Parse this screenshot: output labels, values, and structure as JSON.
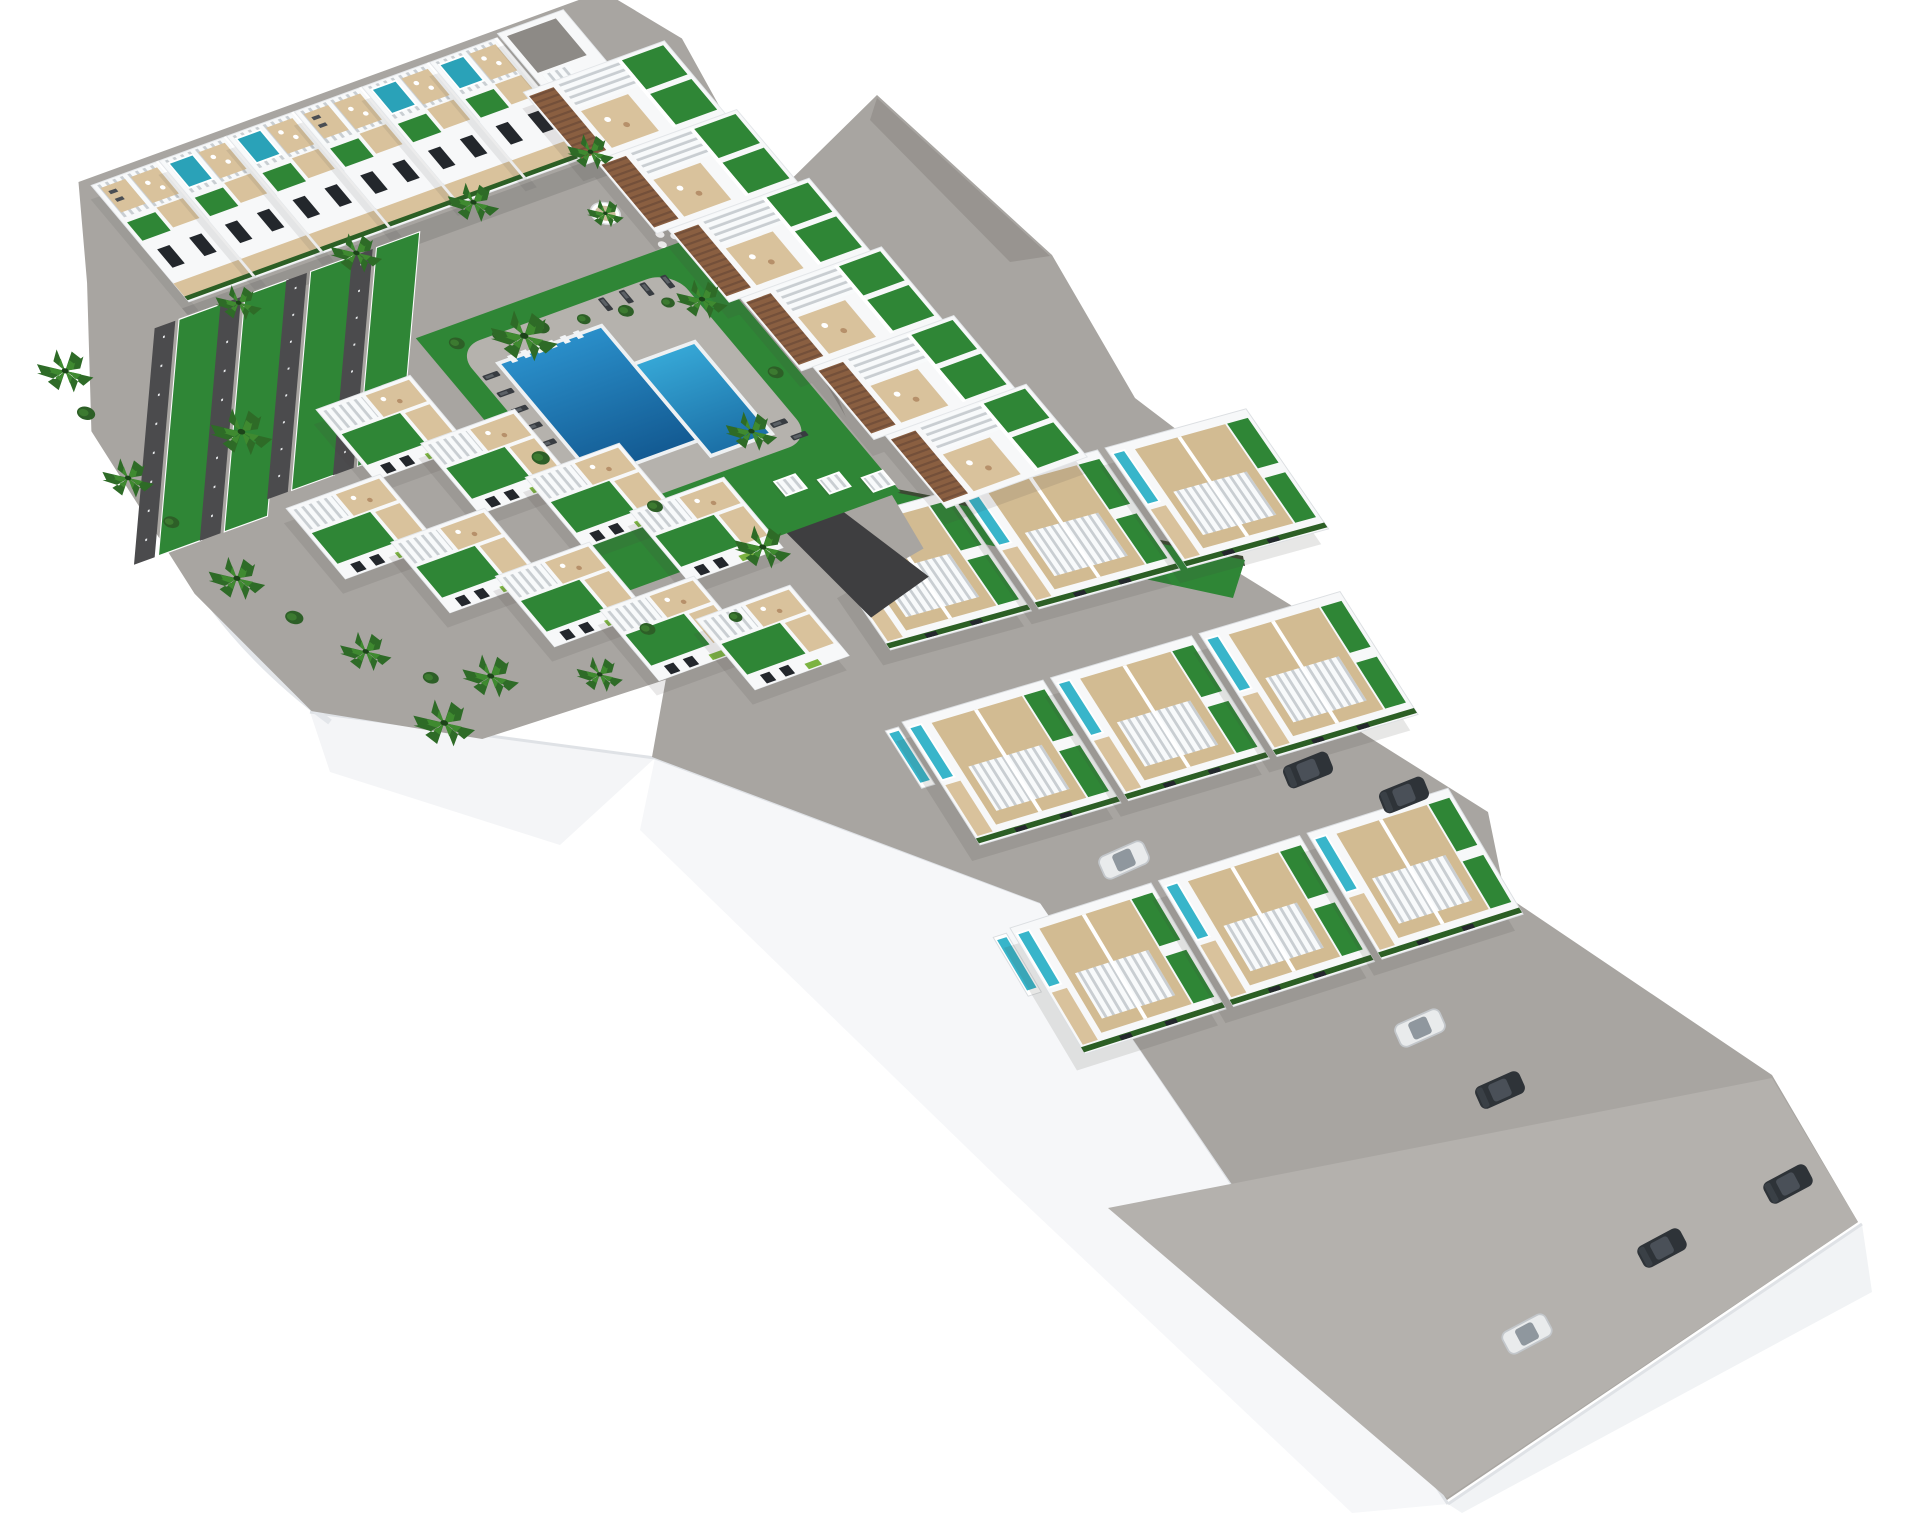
{
  "title": "Aerial 3D architectural render of a white Mediterranean residential complex with communal pool, grass-covered parking rows, rooftop terraces and three rows of detached villas",
  "colors": {
    "bg": "#ffffff",
    "road": "#a8a5a1",
    "roadlight": "#b4b1ad",
    "roaddark": "#8f8c88",
    "pathdark": "#3e3e40",
    "grass": "#2f8636",
    "grassdark": "#27702c",
    "hedge": "#2c5f25",
    "hedgedark": "#3c4a33",
    "gabion": "#6b5138",
    "pooldeep": "#135a92",
    "poolmain": "#2a8fca",
    "poollight": "#36a7d6",
    "poolroof": "#2aa2b8",
    "poolvilla": "#38b5ca",
    "deck": "#d9c29c",
    "deck2": "#d2bb92",
    "pooldeckgray": "#b5b2ad",
    "bwhite": "#f7f8f9",
    "wallshade": "#d9dcde",
    "win": "#23272c",
    "wood": "#8a5f41",
    "slatgap": "#c9ced2",
    "cardark": "#2e3338",
    "carwhite": "#e9ebec",
    "plinth": "#f4f5f7",
    "plinthedge": "#dfe2e6",
    "shadow": "rgba(66,63,58,0.28)"
  },
  "inventory": {
    "main_block": {
      "top_townhouse_units": 6,
      "corner_building": 1,
      "apartment_units": 6,
      "bottom_townhouses": 9,
      "grass_parking_strips": 4,
      "communal_pools": 2,
      "rooftop_pools": 4,
      "sun_loungers": 11,
      "pool_cabanas": 3,
      "palm_trees": 16
    },
    "right_wing": {
      "villa_rows": 3,
      "villa_pairs_per_row": 3,
      "private_plunge_pools": 9,
      "parked_cars": 8
    }
  },
  "instances": {
    "top_row_units": [
      [
        0,
        -6,
        "deck"
      ],
      [
        72,
        -6,
        "pool"
      ],
      [
        144,
        -6,
        "pool"
      ],
      [
        216,
        -6,
        "deck"
      ],
      [
        288,
        -6,
        "pool"
      ],
      [
        360,
        -6,
        "pool"
      ]
    ],
    "apartment_units": [
      [
        416,
        58
      ],
      [
        428,
        153
      ],
      [
        440,
        248
      ],
      [
        452,
        343
      ],
      [
        464,
        438
      ],
      [
        476,
        533
      ]
    ],
    "bottom_houses": [
      [
        30,
        300
      ],
      [
        92,
        372
      ],
      [
        154,
        444
      ],
      [
        216,
        516
      ],
      [
        -62,
        388
      ],
      [
        0,
        460
      ],
      [
        62,
        532
      ],
      [
        124,
        604
      ],
      [
        196,
        648
      ]
    ],
    "parking_strips": [
      [
        0,
        1.08
      ],
      [
        70,
        1.08
      ],
      [
        140,
        1.0
      ],
      [
        210,
        1.0
      ]
    ],
    "loungers": [
      [
        338,
        300,
        90
      ],
      [
        360,
        300,
        90
      ],
      [
        382,
        300,
        90
      ],
      [
        404,
        300,
        90
      ],
      [
        196,
        330,
        0
      ],
      [
        196,
        352,
        0
      ],
      [
        196,
        374,
        0
      ],
      [
        196,
        396,
        0
      ],
      [
        196,
        418,
        0
      ],
      [
        398,
        482,
        0
      ],
      [
        406,
        502,
        0
      ]
    ],
    "cabanas": [
      [
        365,
        548
      ],
      [
        402,
        562
      ],
      [
        439,
        576
      ]
    ],
    "pool_ticks": [
      [
        222,
        316
      ],
      [
        236,
        316
      ],
      [
        250,
        316
      ],
      [
        264,
        316
      ],
      [
        278,
        316
      ],
      [
        292,
        316
      ]
    ],
    "pot_palms": [
      [
        400,
        209
      ]
    ],
    "palms": [
      [
        -148,
        170,
        1.1
      ],
      [
        -170,
        300,
        1.0
      ],
      [
        -150,
        440,
        1.1
      ],
      [
        -95,
        560,
        1.0
      ],
      [
        -10,
        630,
        1.1
      ],
      [
        -80,
        660,
        1.2
      ],
      [
        80,
        668,
        0.9
      ],
      [
        40,
        165,
        0.9
      ],
      [
        170,
        158,
        1.0
      ],
      [
        300,
        150,
        1.0
      ],
      [
        430,
        142,
        0.9
      ],
      [
        -46,
        295,
        1.2
      ],
      [
        250,
        302,
        1.3
      ],
      [
        420,
        330,
        1.0
      ],
      [
        370,
        480,
        1.0
      ],
      [
        300,
        600,
        1.1
      ]
    ],
    "shrubs": [
      [
        190,
        285,
        7
      ],
      [
        230,
        292,
        6
      ],
      [
        270,
        300,
        7
      ],
      [
        310,
        307,
        6
      ],
      [
        350,
        314,
        7
      ],
      [
        390,
        321,
        6
      ],
      [
        180,
        430,
        8
      ],
      [
        240,
        520,
        7
      ],
      [
        430,
        430,
        7
      ],
      [
        -160,
        220,
        8
      ],
      [
        -165,
        360,
        7
      ],
      [
        -130,
        500,
        8
      ],
      [
        -60,
        610,
        7
      ],
      [
        150,
        640,
        7
      ],
      [
        230,
        660,
        6
      ]
    ],
    "villa_rows": [
      {
        "layer": "villa-row-a",
        "u": [
          0,
          158,
          316
        ]
      },
      {
        "layer": "villa-row-b",
        "u": [
          0,
          158,
          316
        ]
      },
      {
        "layer": "villa-row-c",
        "u": [
          0,
          158,
          316
        ]
      }
    ],
    "cars": [
      [
        1308,
        770,
        -22,
        "dark"
      ],
      [
        1404,
        795,
        -22,
        "dark"
      ],
      [
        1124,
        860,
        -24,
        "white"
      ],
      [
        1420,
        1028,
        -24,
        "white"
      ],
      [
        1500,
        1090,
        -24,
        "dark"
      ],
      [
        1527,
        1334,
        -28,
        "white"
      ],
      [
        1662,
        1248,
        -28,
        "dark"
      ],
      [
        1788,
        1184,
        -28,
        "dark"
      ]
    ]
  }
}
